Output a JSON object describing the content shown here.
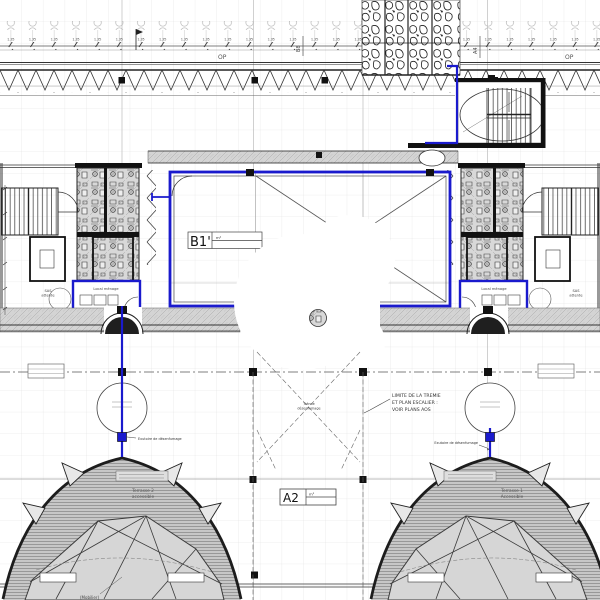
{
  "meta": {
    "type": "architectural-floor-plan",
    "level": "roof / terrace level"
  },
  "colors": {
    "highlight_blue": "#1a1acd",
    "wall_dark": "#1c1c1c",
    "hatch_gray": "#c9c9c9",
    "grid_gray": "#e0e0e0"
  },
  "dimensions": {
    "segment_label": "1.35"
  },
  "markers": {
    "op_left": "OP",
    "op_right": "OP",
    "section_b8": "B8",
    "section_a4": "A4"
  },
  "rooms": {
    "b1": {
      "name": "B1'",
      "area": "m²"
    },
    "a2": {
      "name": "A2",
      "area": "m²"
    },
    "sas_left": {
      "line1": "SAS",
      "line2": "attente"
    },
    "sas_right": {
      "line1": "SAS",
      "line2": "attente"
    },
    "local_left": "Local ménage",
    "local_right": "Local ménage"
  },
  "tremie": {
    "line1": "Trémie",
    "line2": "désenfumage"
  },
  "note": {
    "line1": "LIMITE DE LA TREMIE",
    "line2": "ET PLAN ESCALIER :",
    "line3": "VOIR PLANS AOS"
  },
  "terraces": {
    "left": {
      "line1": "Terrasse 2",
      "line2": "accessible"
    },
    "right": {
      "line1": "Terrasse 1",
      "line2": "Accessible"
    }
  },
  "annotations": {
    "left_apex": "Exutoire de désenfumage",
    "right_apex": "Exutoire de désenfumage",
    "mobilier": "(Mobilier)"
  }
}
